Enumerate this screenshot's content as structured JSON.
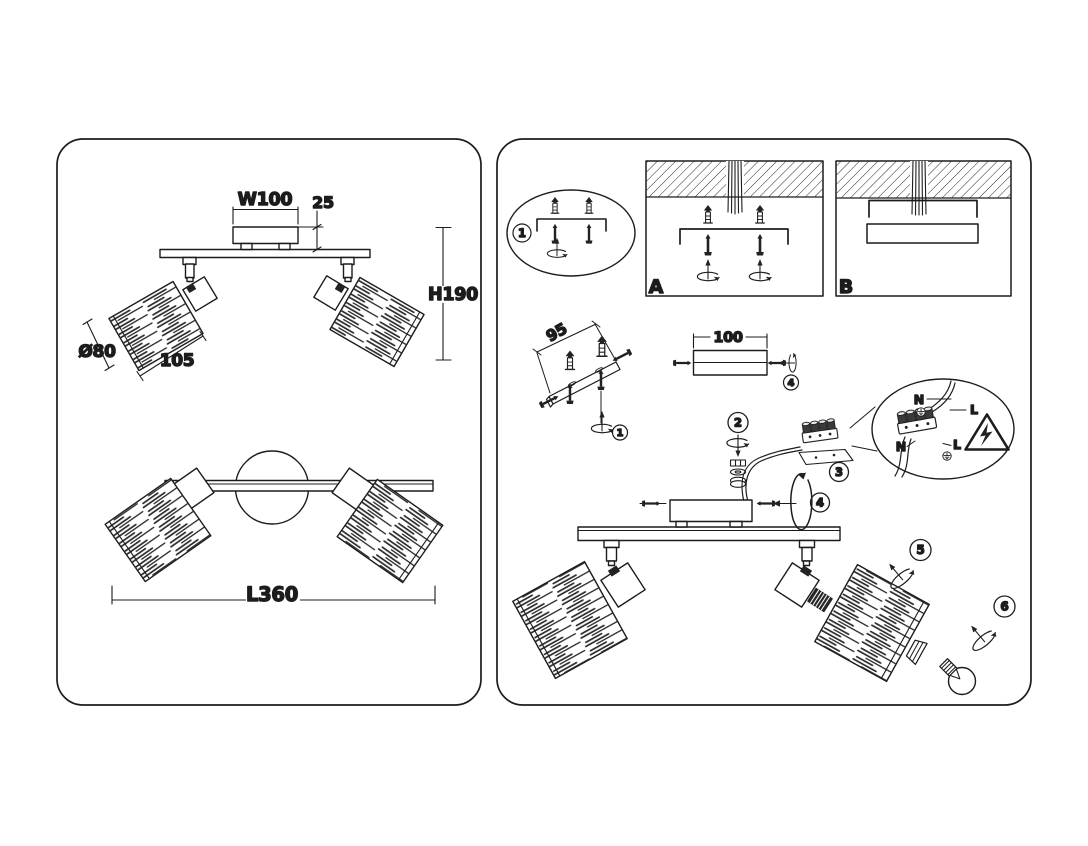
{
  "diagram": {
    "left_panel": {
      "side_view": {
        "canopy_width_label": "W100",
        "canopy_height_label": "25",
        "fixture_height_label": "H190",
        "shade_diameter_label": "Ø80",
        "shade_length_label": "105"
      },
      "bottom_view": {
        "fixture_length_label": "L360"
      }
    },
    "right_panel": {
      "options": {
        "a": "A",
        "b": "B"
      },
      "dimensions": {
        "bracket_hole_spacing": "95",
        "mounting_bar_length": "100"
      },
      "steps": {
        "s1": "1",
        "s2": "2",
        "s3": "3",
        "s4": "4",
        "s5": "5",
        "s6": "6"
      },
      "wiring": {
        "neutral": "N",
        "live": "L"
      }
    }
  },
  "colors": {
    "ink": "#1c1c1c",
    "background": "#ffffff"
  }
}
